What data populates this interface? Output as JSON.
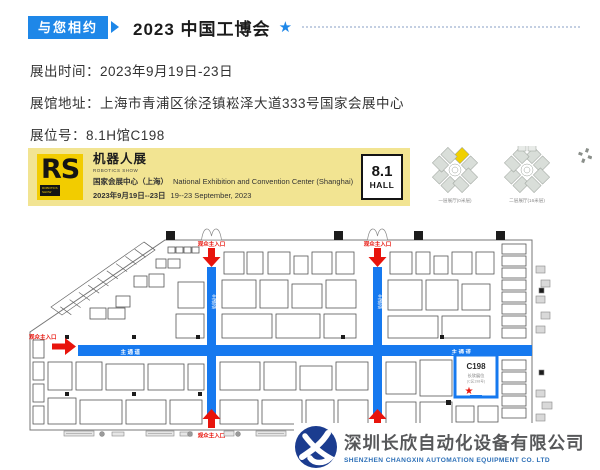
{
  "header": {
    "badge": "与您相约",
    "title": "2023 中国工博会",
    "star": "★"
  },
  "info": {
    "lines": [
      {
        "label": "展出时间：",
        "value": "2023年9月19日-23日"
      },
      {
        "label": "展馆地址：",
        "value": "上海市青浦区徐泾镇崧泽大道333号国家会展中心"
      },
      {
        "label": "展位号：",
        "value": "8.1H馆C198"
      }
    ]
  },
  "banner": {
    "rs": "RS",
    "rs_sub": "ROBOTICS SHOW",
    "title_cn": "机器人展",
    "title_en": "ROBOTICS SHOW",
    "venue_cn": "国家会展中心（上海）",
    "venue_en": "National Exhibition and Convention Center (Shanghai)",
    "date_cn": "2023年9月19日--23日",
    "date_en": "19--23 September, 2023",
    "hall_no": "8.1",
    "hall_word": "HALL"
  },
  "overview": {
    "floor1": "一层展厅(0米层)",
    "floor2": "二层展厅(16米层)"
  },
  "map": {
    "aisle_label": "主通道",
    "entrances": {
      "top1": "观众主入口",
      "top2": "观众主入口",
      "left": "观众主入口",
      "bottom1": "观众主入口",
      "bottom2": "观众主入口"
    },
    "booth": {
      "code": "C198",
      "line1": "长欣展位",
      "line2": "(C区198号)",
      "star": "★"
    }
  },
  "footer": {
    "company_cn": "深圳长欣自动化设备有限公司",
    "company_en": "SHENZHEN CHANGXIN AUTOMATION EQUIPMENT CO. LTD"
  },
  "colors": {
    "accent_blue": "#1E87E8",
    "aisle_blue": "#1679EF",
    "entrance_red": "#E8140C",
    "banner_yellow": "#F2E492",
    "logo_gold": "#F2CC00",
    "navy": "#1B3C8F"
  }
}
